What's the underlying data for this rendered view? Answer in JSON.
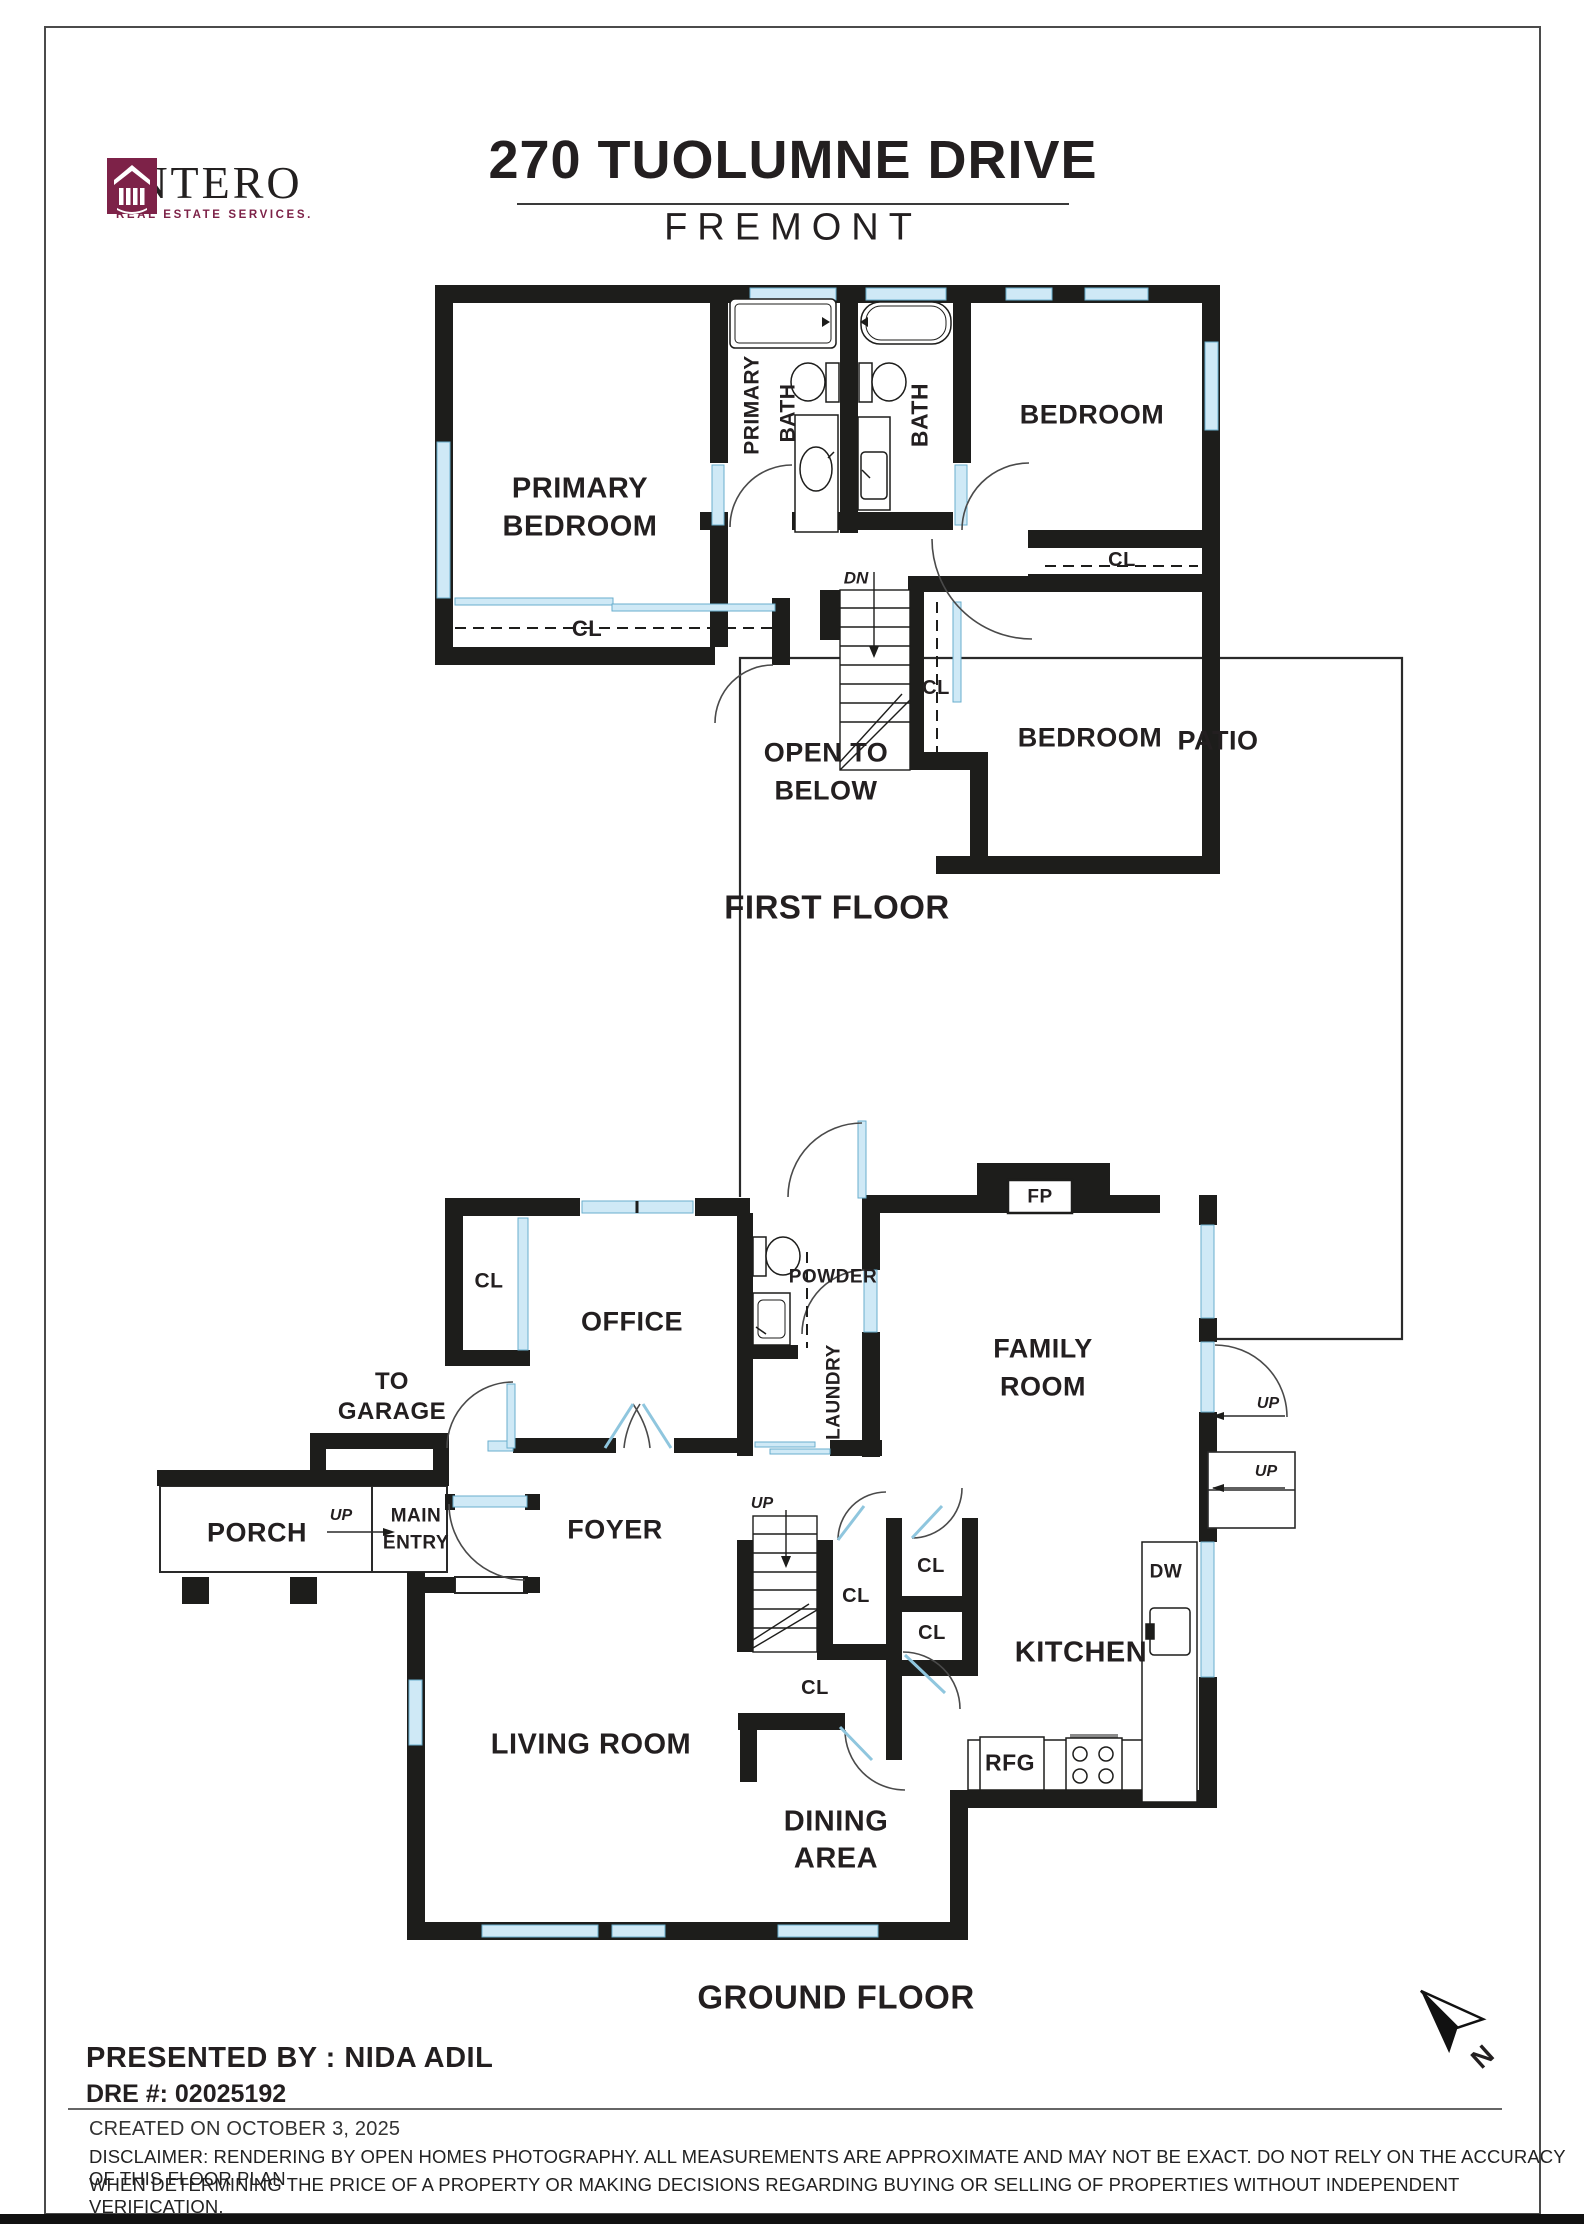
{
  "colors": {
    "wall": "#1d1d1b",
    "window_fill": "#cfe9f6",
    "window_stroke": "#69aecd",
    "brand_maroon": "#7d2248",
    "text": "#231f20"
  },
  "header": {
    "logo_name": "INTERO",
    "logo_tagline": "REAL ESTATE SERVICES.",
    "logo_icon": "intero-portico-icon",
    "title": "270 TUOLUMNE DRIVE",
    "subtitle": "FREMONT"
  },
  "ff": {
    "caption": "FIRST FLOOR",
    "primary_bedroom_l1": "PRIMARY",
    "primary_bedroom_l2": "BEDROOM",
    "primary_bath_l1": "PRIMARY",
    "primary_bath_l2": "BATH",
    "bath": "BATH",
    "bedroom_top": "BEDROOM",
    "bedroom_bottom": "BEDROOM",
    "cl_top_right": "CL",
    "cl_primary": "CL",
    "cl_hall": "CL",
    "dn": "DN",
    "open_below_l1": "OPEN TO",
    "open_below_l2": "BELOW"
  },
  "gf": {
    "caption": "GROUND FLOOR",
    "patio": "PATIO",
    "fp": "FP",
    "cl_office": "CL",
    "office": "OFFICE",
    "powder": "POWDER",
    "laundry": "LAUNDRY",
    "family_l1": "FAMILY",
    "family_l2": "ROOM",
    "to_garage_l1": "TO",
    "to_garage_l2": "GARAGE",
    "porch": "PORCH",
    "up_porch": "UP",
    "main_entry_l1": "MAIN",
    "main_entry_l2": "ENTRY",
    "foyer": "FOYER",
    "up_stairs": "UP",
    "up_patio_1": "UP",
    "up_patio_2": "UP",
    "cl_1": "CL",
    "cl_2": "CL",
    "cl_3": "CL",
    "cl_4": "CL",
    "kitchen": "KITCHEN",
    "dw": "DW",
    "rfg": "RFG",
    "living_room": "LIVING ROOM",
    "dining_l1": "DINING",
    "dining_l2": "AREA"
  },
  "footer": {
    "presented_by": "PRESENTED BY : NIDA ADIL",
    "dre": "DRE #: 02025192",
    "created": "CREATED ON OCTOBER 3, 2025",
    "disclaimer_l1": "DISCLAIMER: RENDERING BY OPEN HOMES PHOTOGRAPHY. ALL MEASUREMENTS ARE APPROXIMATE AND MAY NOT BE EXACT. DO NOT RELY ON THE ACCURACY OF THIS FLOOR PLAN",
    "disclaimer_l2": "WHEN DETERMINING THE PRICE OF A PROPERTY OR MAKING DECISIONS REGARDING BUYING OR SELLING OF PROPERTIES WITHOUT INDEPENDENT VERIFICATION.",
    "compass_n": "N"
  }
}
